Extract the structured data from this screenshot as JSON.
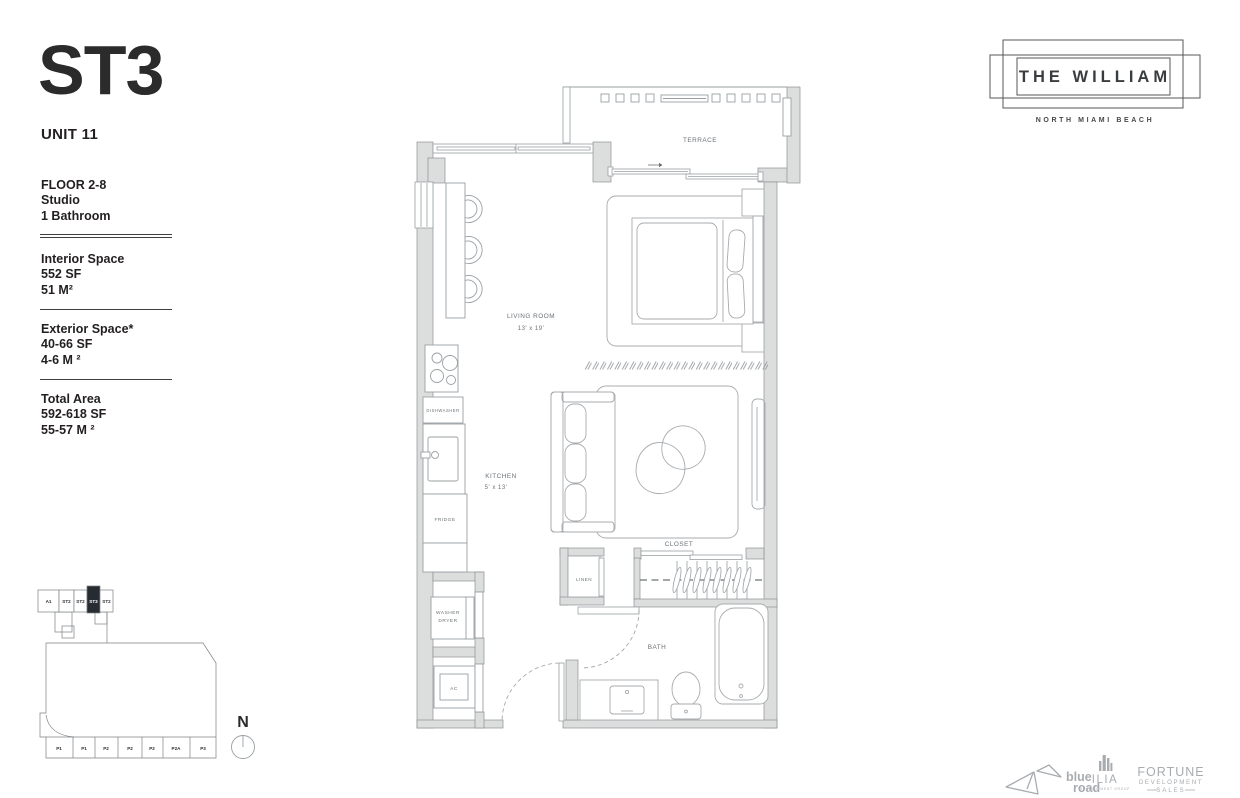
{
  "unit": {
    "code": "ST3",
    "number": "UNIT 11"
  },
  "brand": {
    "name": "THE WILLIAM",
    "location": "NORTH MIAMI BEACH"
  },
  "specs": {
    "floor": "FLOOR 2-8",
    "layout": "Studio",
    "bath": "1 Bathroom",
    "interior_label": "Interior Space",
    "interior_sf": "552 SF",
    "interior_m": "51 M²",
    "exterior_label": "Exterior Space*",
    "exterior_sf": "40-66 SF",
    "exterior_m": "4-6 M ²",
    "total_label": "Total Area",
    "total_sf": "592-618 SF",
    "total_m": "55-57 M ²"
  },
  "plan_labels": {
    "terrace": "TERRACE",
    "living": "LIVING ROOM",
    "living_dim": "13' x 19'",
    "kitchen": "KITCHEN",
    "kitchen_dim": "5' x 13'",
    "closet": "CLOSET",
    "linen": "LINEN",
    "bath": "BATH",
    "dishwasher": "DISHWASHER",
    "fridge": "FRIDGE",
    "washer": "WASHER",
    "dryer": "DRYER",
    "ac": "AC"
  },
  "keyplan": {
    "units": [
      "A1",
      "ST2",
      "ST2",
      "ST3",
      "ST2"
    ],
    "highlight": "ST3",
    "parking": [
      "P1",
      "P1",
      "P2",
      "P2",
      "P2",
      "P2A",
      "P3"
    ]
  },
  "compass": {
    "label": "N"
  },
  "footer": {
    "blueroad_1": "blue",
    "blueroad_2": "road",
    "ilia": "ILIA",
    "ilia_sub": "DEVELOPMENT GROUP",
    "fortune_1": "FORTUNE",
    "fortune_2": "DEVELOPMENT",
    "fortune_3": "SALES"
  },
  "colors": {
    "wall": "#dcdddd",
    "line": "#9aa0a3",
    "ink": "#231f20",
    "highlight": "#272c33",
    "footer_gray": "#a8acb0"
  }
}
